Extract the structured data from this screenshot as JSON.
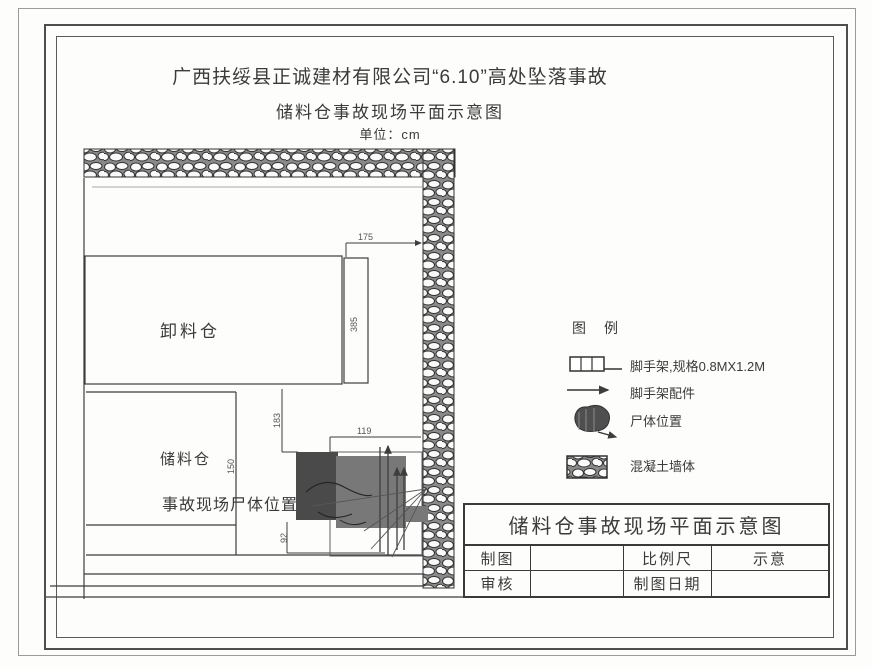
{
  "header": {
    "title_line1": "广西扶绥县正诚建材有限公司“6.10”高处坠落事故",
    "title_line2": "储料仓事故现场平面示意图",
    "unit_label": "单位：cm"
  },
  "plan": {
    "unloading_silo_label": "卸料仓",
    "storage_silo_label": "储料仓",
    "body_position_label": "事故现场尸体位置",
    "dimensions": {
      "wall_gap_width": "175",
      "unloading_silo_depth": "385",
      "passage_height": "183",
      "scaffold_area_width": "119",
      "storage_silo_height": "150",
      "step_height": "92"
    }
  },
  "legend": {
    "title": "图　例",
    "items": [
      {
        "icon": "scaffold-icon",
        "label": "脚手架,规格0.8MX1.2M"
      },
      {
        "icon": "scaffold-parts-arrow-icon",
        "label": "脚手架配件"
      },
      {
        "icon": "body-position-icon",
        "label": "尸体位置"
      },
      {
        "icon": "concrete-wall-icon",
        "label": "混凝土墙体"
      }
    ]
  },
  "title_block": {
    "title": "储料仓事故现场平面示意图",
    "drawn_by_label": "制图",
    "scale_label": "比例尺",
    "scale_value": "示意",
    "checked_by_label": "审核",
    "date_label": "制图日期"
  },
  "colors": {
    "line": "#3d3d3d",
    "text": "#3b3b3b",
    "paper": "#fdfdfb",
    "body_blob_dark": "#4a4a4a",
    "body_blob_mid": "#787878"
  }
}
